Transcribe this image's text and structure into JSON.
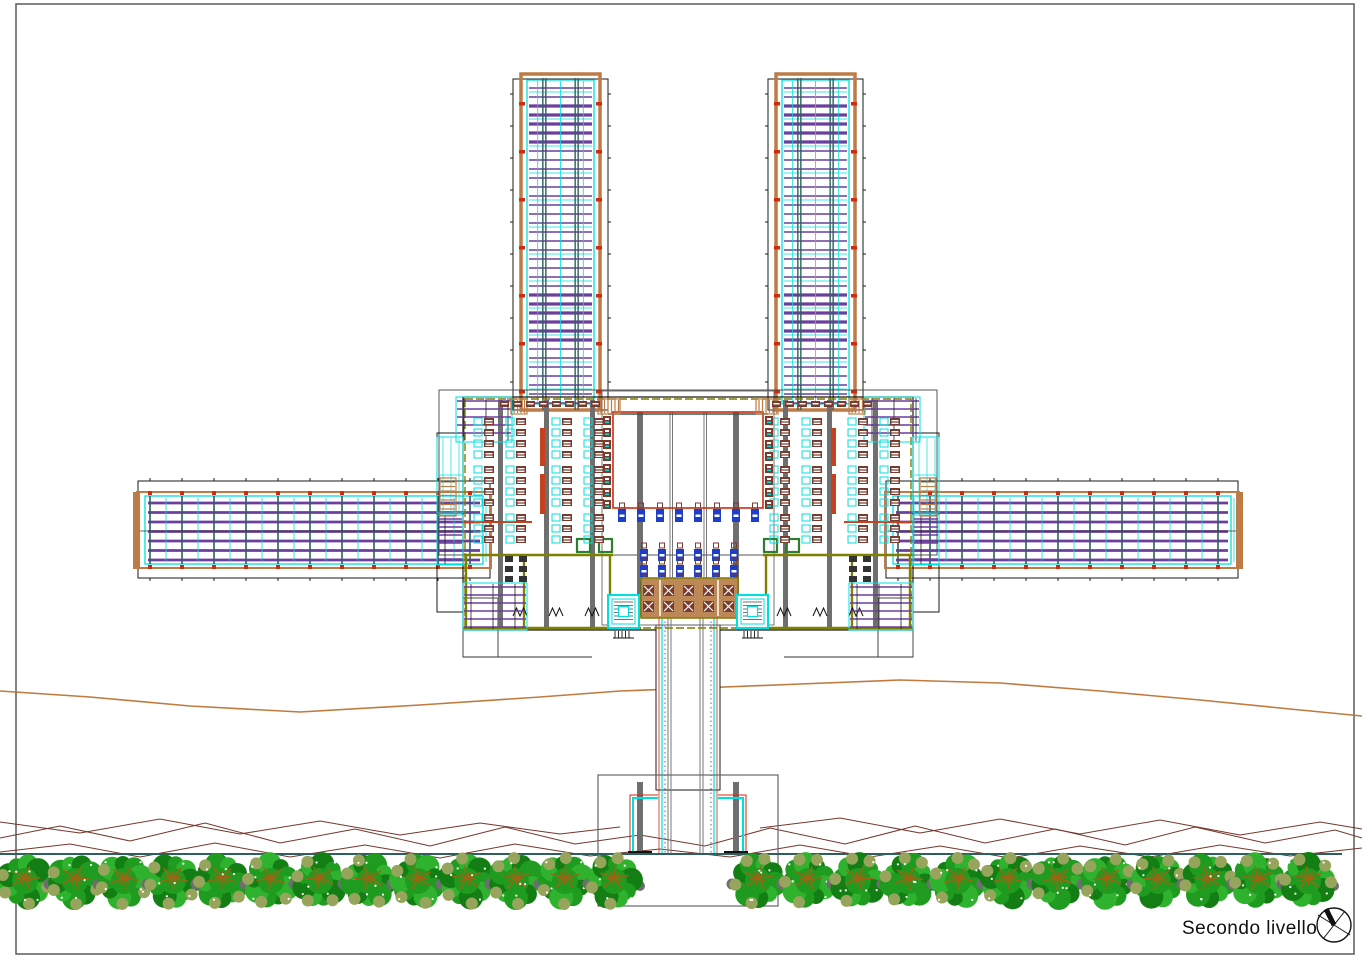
{
  "title": {
    "text": "Secondo livello"
  },
  "compass": {
    "cx": 1334,
    "cy": 925,
    "r": 17
  },
  "palette": {
    "paper": "#FFFFFF",
    "border": "#5A5A5A",
    "black": "#1A1A1A",
    "gray": "#6F6F6F",
    "dgray": "#555555",
    "purple": "#6C3F9E",
    "cyan": "#00DFDF",
    "teal": "#2E5F5F",
    "red": "#D02A10",
    "tan": "#BE7B45",
    "contour": "#C07A3E",
    "ridge": "#74362B",
    "olive": "#7F7F00",
    "green": "#2F7D32",
    "seat": "#7A3A2E",
    "blue": "#1E3EC8",
    "deck": "#BD8756",
    "treeG1": "#1F9B1F",
    "treeG2": "#2FB32F",
    "treeG3": "#137E13",
    "treeOlive": "#97A45C",
    "treeGray": "#6E6E6E",
    "treeStar": "#9A6614"
  },
  "plan": {
    "sheet": {
      "x": 16,
      "y": 4,
      "w": 1338,
      "h": 950
    },
    "towers": [
      {
        "x": 513,
        "y": 74,
        "w": 95,
        "h": 336
      },
      {
        "x": 768,
        "y": 74,
        "w": 95,
        "h": 336
      }
    ],
    "wings": [
      {
        "x": 138,
        "y": 481,
        "w": 352,
        "h": 97,
        "end": -1
      },
      {
        "x": 886,
        "y": 481,
        "w": 352,
        "h": 97,
        "end": 1
      }
    ],
    "building": {
      "roof_outline": {
        "x": 439,
        "y": 390,
        "w": 498,
        "h": 165
      },
      "bay_outline": {
        "x": 602,
        "y": 391,
        "w": 172,
        "h": 234
      },
      "footprint": {
        "left": 463,
        "top": 397,
        "right": 913,
        "bottom": 630,
        "gapL": 656,
        "gapR": 720
      },
      "bumps": [
        {
          "x": 437,
          "y": 433,
          "w": 26,
          "h": 179
        },
        {
          "x": 913,
          "y": 433,
          "w": 26,
          "h": 179
        }
      ],
      "hall": {
        "x": 613,
        "y": 412,
        "w": 150,
        "h": 96
      },
      "hall_cols_wide": [
        637,
        733
      ],
      "hall_cols_thin": [
        670,
        704
      ],
      "block_cols": [
        498,
        544,
        590,
        783,
        827,
        873
      ],
      "red_strips": [
        {
          "x": 540,
          "segs": [
            [
              428,
              466
            ],
            [
              474,
              514
            ]
          ]
        },
        {
          "x": 831,
          "segs": [
            [
              428,
              466
            ],
            [
              474,
              514
            ]
          ]
        }
      ],
      "seat_bands": [
        474,
        506,
        552,
        584,
        770,
        802,
        848,
        880
      ],
      "seat_groups": [
        {
          "y": 418,
          "rows": 4
        },
        {
          "y": 466,
          "rows": 4
        },
        {
          "y": 514,
          "rows": 3
        }
      ],
      "top_seat_rows": [
        {
          "x": 500,
          "y": 401,
          "n": 8
        },
        {
          "x": 772,
          "y": 401,
          "n": 8
        }
      ],
      "hall_fixtures": [
        {
          "x": 603,
          "y": 416,
          "n": 8
        },
        {
          "x": 765,
          "y": 416,
          "n": 8
        }
      ],
      "bench_row": {
        "x": 618,
        "y": 509,
        "n": 8,
        "dx": 19
      },
      "bench_block": {
        "x": 640,
        "y": 549,
        "cols": 6,
        "rows": 3,
        "dx": 18,
        "dy": 16
      },
      "deck": {
        "x": 641,
        "y": 578,
        "w": 97,
        "h": 40
      },
      "deck_tables": {
        "x": 643,
        "y": 585,
        "cols": 5,
        "rows": 2,
        "dx": 20,
        "dy": 16
      },
      "stair_cores": [
        {
          "x": 608,
          "y": 595,
          "w": 31,
          "h": 33
        },
        {
          "x": 737,
          "y": 595,
          "w": 31,
          "h": 33
        }
      ],
      "green_doors": [
        {
          "x": 577,
          "y": 539
        },
        {
          "x": 599,
          "y": 539
        },
        {
          "x": 764,
          "y": 539
        },
        {
          "x": 786,
          "y": 539
        }
      ],
      "olive_h": [
        [
          463,
          613,
          555
        ],
        [
          763,
          913,
          555
        ],
        [
          463,
          641,
          628
        ],
        [
          737,
          913,
          628
        ]
      ],
      "olive_v": [
        [
          466,
          555,
          628
        ],
        [
          524,
          555,
          628
        ],
        [
          610,
          555,
          628
        ],
        [
          766,
          555,
          628
        ],
        [
          852,
          555,
          628
        ],
        [
          910,
          555,
          628
        ]
      ],
      "red_walls": [
        [
          463,
          532,
          522
        ],
        [
          844,
          913,
          522
        ]
      ],
      "door_swings": [
        [
          520,
          612
        ],
        [
          556,
          612
        ],
        [
          592,
          612
        ],
        [
          784,
          612
        ],
        [
          820,
          612
        ],
        [
          856,
          612
        ]
      ],
      "toilets": {
        "xs": [
          505,
          519,
          849,
          863
        ],
        "ys": [
          556,
          566,
          576
        ]
      },
      "louver_patches": [
        {
          "x": 456,
          "y": 397,
          "w": 56,
          "h": 45
        },
        {
          "x": 864,
          "y": 397,
          "w": 56,
          "h": 45
        },
        {
          "x": 463,
          "y": 583,
          "w": 64,
          "h": 47
        },
        {
          "x": 849,
          "y": 583,
          "w": 64,
          "h": 47
        },
        {
          "x": 437,
          "y": 515,
          "w": 26,
          "h": 50
        },
        {
          "x": 913,
          "y": 515,
          "w": 26,
          "h": 50
        }
      ],
      "cyan_patches": [
        {
          "x": 437,
          "y": 437,
          "w": 26,
          "h": 76
        },
        {
          "x": 913,
          "y": 437,
          "w": 26,
          "h": 76
        }
      ],
      "top_ladders": [
        {
          "x": 511,
          "y": 399,
          "w": 16,
          "h": 15
        },
        {
          "x": 598,
          "y": 399,
          "w": 22,
          "h": 15
        },
        {
          "x": 756,
          "y": 399,
          "w": 22,
          "h": 15
        },
        {
          "x": 849,
          "y": 399,
          "w": 16,
          "h": 15
        }
      ],
      "edge_ladders": [
        {
          "x": 440,
          "y": 478,
          "w": 16,
          "h": 38
        },
        {
          "x": 920,
          "y": 478,
          "w": 16,
          "h": 38
        }
      ],
      "step_outlines": [
        {
          "x": 463,
          "y": 598,
          "w": 35,
          "h": 59
        },
        {
          "x": 878,
          "y": 598,
          "w": 35,
          "h": 59
        }
      ],
      "step_lines": [
        [
          463,
          592,
          657
        ],
        [
          784,
          913,
          657
        ]
      ],
      "teal_top": [
        608,
        768,
        414
      ]
    },
    "bridge": {
      "rect": {
        "x": 656,
        "y": 625,
        "w": 64,
        "h": 165
      },
      "gray_pairs": [
        668,
        700
      ],
      "cyan_lines": [
        662,
        714
      ],
      "red_lines": [
        659,
        717
      ],
      "purple_dash": [
        665,
        711
      ],
      "y1": 617,
      "y2": 853
    },
    "terminal": {
      "rect": {
        "x": 598,
        "y": 775,
        "w": 180,
        "h": 131
      },
      "bars": [
        {
          "x": 637,
          "y": 782,
          "w": 6,
          "h": 72
        },
        {
          "x": 733,
          "y": 782,
          "w": 6,
          "h": 72
        }
      ],
      "brackets": [
        {
          "cyan": [
            [
              658,
              798
            ],
            [
              633,
              798
            ],
            [
              633,
              853
            ]
          ],
          "red": [
            [
              658,
              795
            ],
            [
              630,
              795
            ],
            [
              630,
              853
            ]
          ]
        },
        {
          "cyan": [
            [
              718,
              798
            ],
            [
              743,
              798
            ],
            [
              743,
              853
            ]
          ],
          "red": [
            [
              718,
              795
            ],
            [
              746,
              795
            ],
            [
              746,
              853
            ]
          ]
        }
      ],
      "base_ticks": [
        [
          628,
          652,
          852
        ],
        [
          724,
          748,
          852
        ]
      ]
    },
    "ground": {
      "teal_line": {
        "x1": 0,
        "x2": 1342,
        "y": 854
      },
      "contour": [
        [
          0,
          691
        ],
        [
          90,
          697
        ],
        [
          190,
          706
        ],
        [
          300,
          712
        ],
        [
          420,
          705
        ],
        [
          540,
          697
        ],
        [
          620,
          691
        ],
        [
          700,
          688
        ],
        [
          800,
          684
        ],
        [
          900,
          680
        ],
        [
          1000,
          683
        ],
        [
          1100,
          691
        ],
        [
          1200,
          700
        ],
        [
          1290,
          709
        ],
        [
          1362,
          716
        ]
      ],
      "ridges": [
        [
          [
            0,
            838
          ],
          [
            60,
            826
          ],
          [
            130,
            841
          ],
          [
            205,
            823
          ],
          [
            280,
            843
          ],
          [
            355,
            829
          ],
          [
            430,
            846
          ],
          [
            505,
            827
          ],
          [
            575,
            844
          ],
          [
            640,
            835
          ],
          [
            705,
            846
          ],
          [
            770,
            828
          ],
          [
            845,
            844
          ],
          [
            915,
            826
          ],
          [
            985,
            843
          ],
          [
            1055,
            829
          ],
          [
            1125,
            845
          ],
          [
            1195,
            827
          ],
          [
            1265,
            843
          ],
          [
            1335,
            830
          ],
          [
            1362,
            838
          ]
        ],
        [
          [
            0,
            852
          ],
          [
            70,
            844
          ],
          [
            140,
            857
          ],
          [
            215,
            843
          ],
          [
            290,
            857
          ],
          [
            365,
            845
          ],
          [
            440,
            858
          ],
          [
            515,
            844
          ],
          [
            590,
            856
          ],
          [
            660,
            849
          ],
          [
            730,
            857
          ],
          [
            800,
            845
          ],
          [
            870,
            857
          ],
          [
            940,
            846
          ],
          [
            1010,
            858
          ],
          [
            1080,
            846
          ],
          [
            1150,
            857
          ],
          [
            1220,
            845
          ],
          [
            1290,
            856
          ],
          [
            1362,
            848
          ]
        ],
        [
          [
            0,
            822
          ],
          [
            80,
            833
          ],
          [
            160,
            819
          ],
          [
            240,
            834
          ],
          [
            320,
            821
          ],
          [
            400,
            835
          ],
          [
            480,
            823
          ],
          [
            560,
            834
          ],
          [
            620,
            827
          ]
        ],
        [
          [
            760,
            828
          ],
          [
            840,
            818
          ],
          [
            920,
            833
          ],
          [
            1000,
            819
          ],
          [
            1080,
            834
          ],
          [
            1160,
            820
          ],
          [
            1240,
            835
          ],
          [
            1320,
            822
          ],
          [
            1362,
            829
          ]
        ]
      ]
    },
    "trees": {
      "cy": 881,
      "r": 27,
      "centers": [
        25,
        75,
        124,
        173,
        222,
        271,
        320,
        369,
        418,
        467,
        516,
        565,
        614,
        758,
        808,
        858,
        908,
        958,
        1008,
        1058,
        1108,
        1158,
        1208,
        1258,
        1308
      ]
    }
  }
}
